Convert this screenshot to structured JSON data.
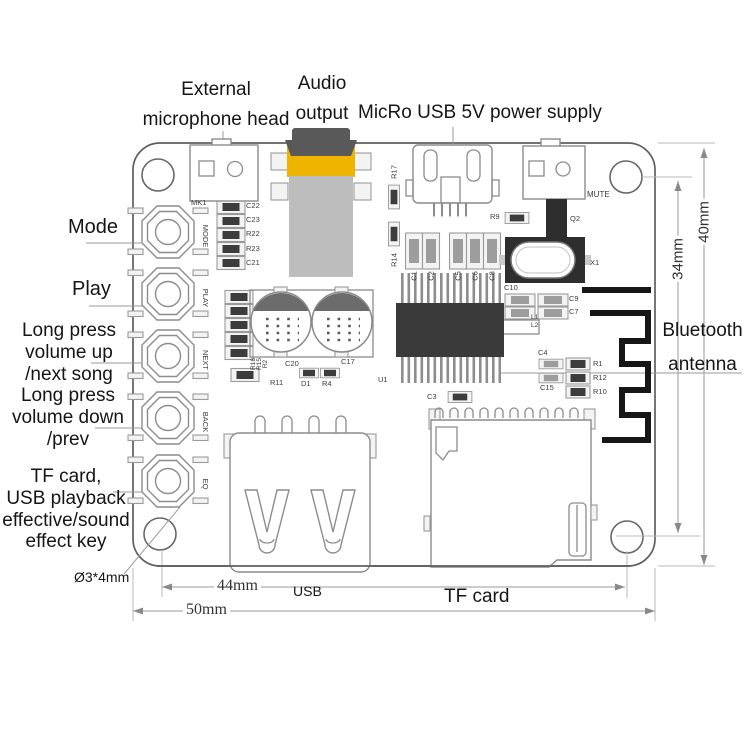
{
  "annotations": {
    "mic": [
      "External",
      "microphone head"
    ],
    "audio": [
      "Audio",
      "output"
    ],
    "power": "MicRo USB 5V power supply",
    "mode": "Mode",
    "play": "Play",
    "volume_up": [
      "Long press",
      "volume up",
      "/next song"
    ],
    "volume_down": [
      "Long press",
      "volume down",
      "/prev"
    ],
    "effect_key": [
      "TF card,",
      "USB playback",
      "effective/sound",
      "effect key"
    ],
    "bluetooth": [
      "Bluetooth",
      "antenna"
    ],
    "usb_port": "USB",
    "tf_card": "TF card",
    "mount_hole": "Ø3*4mm"
  },
  "dimensions": {
    "hole_spacing_x": "44mm",
    "board_width": "50mm",
    "hole_spacing_y": "34mm",
    "board_height": "40mm"
  },
  "board": {
    "labels": [
      {
        "t": "MK1",
        "x": 191,
        "y": 199
      },
      {
        "t": "MODE",
        "x": 205,
        "y": 236,
        "r": 90
      },
      {
        "t": "PLAY",
        "x": 205,
        "y": 298,
        "r": 90
      },
      {
        "t": "NEXT",
        "x": 205,
        "y": 360,
        "r": 90
      },
      {
        "t": "BACK",
        "x": 205,
        "y": 422,
        "r": 90
      },
      {
        "t": "EQ",
        "x": 205,
        "y": 484,
        "r": 90
      },
      {
        "t": "C22",
        "x": 246,
        "y": 202
      },
      {
        "t": "C23",
        "x": 246,
        "y": 216
      },
      {
        "t": "R22",
        "x": 246,
        "y": 230
      },
      {
        "t": "R23",
        "x": 246,
        "y": 245
      },
      {
        "t": "C21",
        "x": 246,
        "y": 259
      },
      {
        "t": "R16",
        "x": 254,
        "y": 364,
        "r": -90,
        "s": 6.5
      },
      {
        "t": "R15",
        "x": 260,
        "y": 364,
        "r": -90,
        "s": 6.5
      },
      {
        "t": "R2",
        "x": 266,
        "y": 364,
        "r": -90,
        "s": 6.5
      },
      {
        "t": "R11",
        "x": 270,
        "y": 379
      },
      {
        "t": "C20",
        "x": 285,
        "y": 360
      },
      {
        "t": "D1",
        "x": 301,
        "y": 380
      },
      {
        "t": "R4",
        "x": 322,
        "y": 380
      },
      {
        "t": "C17",
        "x": 341,
        "y": 358
      },
      {
        "t": "U1",
        "x": 378,
        "y": 376
      },
      {
        "t": "R17",
        "x": 394,
        "y": 172,
        "r": -90
      },
      {
        "t": "R14",
        "x": 394,
        "y": 260,
        "r": -90
      },
      {
        "t": "C1",
        "x": 414,
        "y": 276,
        "r": -90
      },
      {
        "t": "C2",
        "x": 431,
        "y": 276,
        "r": -90
      },
      {
        "t": "C5",
        "x": 458,
        "y": 276,
        "r": -90
      },
      {
        "t": "C6",
        "x": 475,
        "y": 276,
        "r": -90
      },
      {
        "t": "C8",
        "x": 492,
        "y": 276,
        "r": -90
      },
      {
        "t": "R9",
        "x": 490,
        "y": 213
      },
      {
        "t": "Q2",
        "x": 570,
        "y": 215
      },
      {
        "t": "MUTE",
        "x": 587,
        "y": 191,
        "s": 8
      },
      {
        "t": "X1",
        "x": 590,
        "y": 259
      },
      {
        "t": "C10",
        "x": 504,
        "y": 284
      },
      {
        "t": "C9",
        "x": 569,
        "y": 295
      },
      {
        "t": "C7",
        "x": 569,
        "y": 308
      },
      {
        "t": "L1",
        "x": 531,
        "y": 315,
        "s": 6.5
      },
      {
        "t": "L2",
        "x": 531,
        "y": 323,
        "s": 6.5
      },
      {
        "t": "C4",
        "x": 538,
        "y": 349
      },
      {
        "t": "C15",
        "x": 540,
        "y": 384
      },
      {
        "t": "R1",
        "x": 593,
        "y": 360
      },
      {
        "t": "R12",
        "x": 593,
        "y": 374
      },
      {
        "t": "R10",
        "x": 593,
        "y": 388
      },
      {
        "t": "C3",
        "x": 427,
        "y": 393
      }
    ]
  }
}
